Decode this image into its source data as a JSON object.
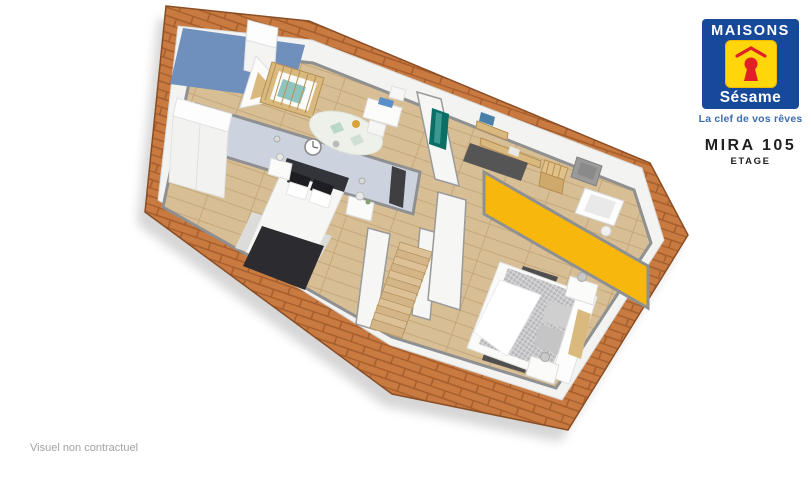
{
  "branding": {
    "logo_title": "MAISONS",
    "logo_subtitle": "Sésame",
    "tagline": "La clef de vos rêves",
    "colors": {
      "logo_blue": "#17499b",
      "logo_yellow": "#ffd60a",
      "logo_red": "#e01f26",
      "tagline_blue": "#3b6db0"
    }
  },
  "plan": {
    "model": "MIRA 105",
    "level": "ETAGE",
    "disclaimer": "Visuel non contractuel"
  },
  "floorplan": {
    "colors": {
      "roof_brick": "#c87a40",
      "roof_mortar": "#a45c2b",
      "roof_edge": "#8a4e26",
      "wall_white": "#f3f3f2",
      "wall_top_gray": "#8f9091",
      "floor_wood": "#d8be94",
      "floor_line": "#c4a87c",
      "accent_blue": "#6f90bd",
      "accent_soft_blue": "#ccd3de",
      "accent_yellow": "#f7b70c",
      "accent_teal": "#0b6f68",
      "stair_wood": "#d3b588",
      "crib_wood": "#d9b97e",
      "dark_fabric": "#2c2c30",
      "quilt_gray": "#b9b9bb",
      "rug_gray": "#dcdcda",
      "rug_dark": "#4f4f4f",
      "shadow": "rgba(0,0,0,0.16)"
    }
  }
}
